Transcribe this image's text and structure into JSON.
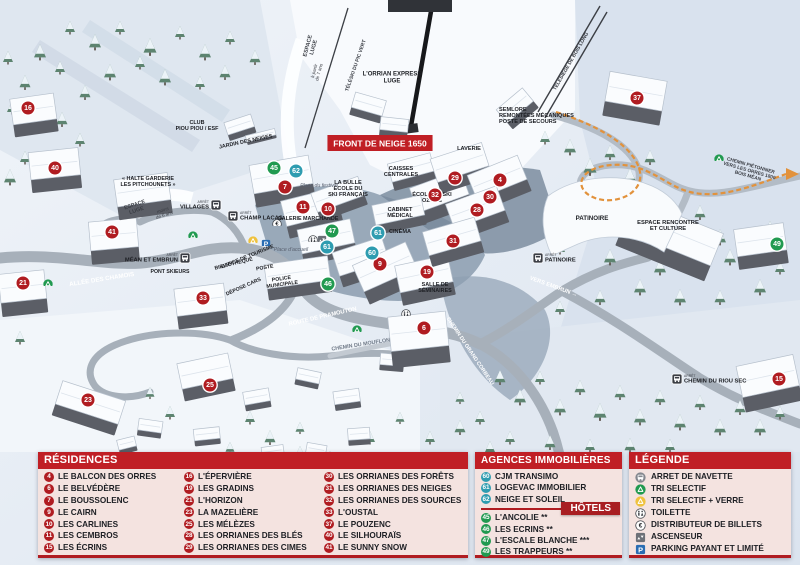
{
  "map": {
    "banner": {
      "text": "FRONT DE NEIGE 1650",
      "x": 380,
      "y": 143
    },
    "marker_colors": {
      "r": "#b01c21",
      "a": "#2e9cb0",
      "h": "#219a50"
    },
    "labels": [
      {
        "t": "ESPACE\nLUGE",
        "x": 312,
        "y": 47,
        "s": 5.5,
        "rot": -75,
        "w": "b",
        "c": "#3a3d44"
      },
      {
        "t": "à partir\nde 7 ans",
        "x": 318,
        "y": 72,
        "s": 4.6,
        "rot": -75,
        "c": "#3a3d44"
      },
      {
        "t": "TÉLÉSKI DU PIC VERT",
        "x": 357,
        "y": 66,
        "s": 5,
        "rot": -71,
        "w": "b",
        "c": "#3a3d44"
      },
      {
        "t": "L'ORRIAN EXPRESS\nLUGE",
        "x": 392,
        "y": 79,
        "s": 6,
        "w": "b",
        "c": "#1d1f24"
      },
      {
        "t": "TÉLÉSIÈGE DE BOIS LONG",
        "x": 572,
        "y": 62,
        "s": 5,
        "rot": -60,
        "w": "b",
        "c": "#3a3d44"
      },
      {
        "t": "SEMLORE\nREMONTÉES MÉCANIQUES\nPOSTE DE SECOURS",
        "x": 499,
        "y": 117,
        "s": 5.6,
        "w": "b",
        "c": "#1d1f24",
        "a": "start"
      },
      {
        "t": "LAVERIE",
        "x": 469,
        "y": 150,
        "s": 5.6,
        "w": "b",
        "c": "#1d1f24"
      },
      {
        "t": "CAISSES\nCENTRALES",
        "x": 401,
        "y": 173,
        "s": 5.6,
        "w": "b",
        "c": "#1d1f24"
      },
      {
        "t": "ÉCOLE DE SKI\nOZONE",
        "x": 432,
        "y": 199,
        "s": 5.6,
        "w": "b",
        "c": "#1d1f24"
      },
      {
        "t": "CABINET\nMÉDICAL",
        "x": 400,
        "y": 214,
        "s": 5.6,
        "w": "b",
        "c": "#1d1f24"
      },
      {
        "t": "CINÉMA",
        "x": 400,
        "y": 233,
        "s": 5.6,
        "w": "b",
        "c": "#1d1f24"
      },
      {
        "t": "LA BULLE\nÉCOLE DU\nSKI FRANÇAIS",
        "x": 348,
        "y": 190,
        "s": 5.6,
        "w": "b",
        "c": "#1d1f24"
      },
      {
        "t": "Place du festival",
        "x": 319,
        "y": 187,
        "s": 5.2,
        "i": true,
        "c": "#5a6170"
      },
      {
        "t": "GALERIE MARCHANDE",
        "x": 308,
        "y": 220,
        "s": 5.4,
        "w": "b",
        "c": "#1d1f24"
      },
      {
        "t": "CLUB\nPIOU PIOU / ESF",
        "x": 197,
        "y": 127,
        "s": 5.4,
        "w": "b",
        "c": "#1d1f24"
      },
      {
        "t": "JARDIN DES NEIGES",
        "x": 246,
        "y": 143,
        "s": 5.4,
        "rot": -12,
        "w": "b",
        "c": "#1d1f24"
      },
      {
        "t": "« HALTE GARDERIE\nLES PITCHOUNETS »",
        "x": 148,
        "y": 183,
        "s": 5.4,
        "w": "b",
        "c": "#1d1f24"
      },
      {
        "t": "ESPACE\nLUGE",
        "x": 136,
        "y": 209,
        "s": 5.4,
        "rot": -18,
        "w": "b",
        "c": "#3a3d44"
      },
      {
        "t": "moins\nde 6 ans",
        "x": 164,
        "y": 214,
        "s": 4.6,
        "rot": -18,
        "c": "#3a3d44"
      },
      {
        "t": "ALLÉE DES CHAMOIS",
        "x": 102,
        "y": 281,
        "s": 6.2,
        "rot": -9,
        "w": "b",
        "c": "#ffffff"
      },
      {
        "t": "PONT SKIEURS",
        "x": 170,
        "y": 273,
        "s": 5.2,
        "w": "b",
        "c": "#1d1f24"
      },
      {
        "t": "BIBLIOTHÈQUE",
        "x": 234,
        "y": 265,
        "s": 5.2,
        "rot": -14,
        "w": "b",
        "c": "#1d1f24"
      },
      {
        "t": "OFFICE DE TOURISME",
        "x": 248,
        "y": 258,
        "s": 5.2,
        "rot": -22,
        "w": "b",
        "c": "#1d1f24"
      },
      {
        "t": "POSTE",
        "x": 265,
        "y": 269,
        "s": 5.2,
        "rot": -10,
        "w": "b",
        "c": "#1d1f24"
      },
      {
        "t": "POLICE\nMUNICIPALE",
        "x": 282,
        "y": 283,
        "s": 5.2,
        "rot": -8,
        "w": "b",
        "c": "#1d1f24"
      },
      {
        "t": "DÉPOSE CARS",
        "x": 244,
        "y": 288,
        "s": 5.2,
        "rot": -24,
        "w": "b",
        "c": "#1d1f24"
      },
      {
        "t": "Place d'accueil",
        "x": 291,
        "y": 251,
        "s": 5.2,
        "i": true,
        "c": "#5a6170"
      },
      {
        "t": "ROUTE DE PRAMOUTON",
        "x": 323,
        "y": 318,
        "s": 5.8,
        "rot": -13,
        "w": "b",
        "c": "#ffffff"
      },
      {
        "t": "CHEMIN DU MOUFLON",
        "x": 361,
        "y": 346,
        "s": 5.4,
        "rot": -9,
        "w": "b",
        "c": "#707a88"
      },
      {
        "t": "CHEMIN DU GRAND CORBEAU",
        "x": 469,
        "y": 352,
        "s": 5.4,
        "rot": 56,
        "w": "b",
        "c": "#ffffff"
      },
      {
        "t": "SALLE DE\nSÉMINAIRES",
        "x": 435,
        "y": 289,
        "s": 5.4,
        "w": "b",
        "c": "#1d1f24"
      },
      {
        "t": "PATINOIRE",
        "x": 592,
        "y": 220,
        "s": 6.2,
        "w": "b",
        "c": "#1d1f24"
      },
      {
        "t": "ESPACE RENCONTRE\nET CULTURE",
        "x": 668,
        "y": 227,
        "s": 5.8,
        "w": "b",
        "c": "#1d1f24"
      },
      {
        "t": "VERS EMBRUN →",
        "x": 553,
        "y": 288,
        "s": 5.8,
        "rot": 20,
        "w": "b",
        "c": "#ffffff"
      },
      {
        "t": "CHEMIN PIÉTONNIER\nVERS LES ORRES 1800\nBOIS MÉAN",
        "x": 749,
        "y": 172,
        "s": 4.8,
        "rot": 16,
        "w": "b",
        "c": "#3a3d44"
      }
    ],
    "markers": [
      {
        "n": "16",
        "x": 28,
        "y": 108,
        "t": "r"
      },
      {
        "n": "40",
        "x": 55,
        "y": 168,
        "t": "r"
      },
      {
        "n": "21",
        "x": 23,
        "y": 283,
        "t": "r"
      },
      {
        "n": "41",
        "x": 112,
        "y": 232,
        "t": "r"
      },
      {
        "n": "33",
        "x": 203,
        "y": 298,
        "t": "r"
      },
      {
        "n": "23",
        "x": 88,
        "y": 400,
        "t": "r"
      },
      {
        "n": "25",
        "x": 210,
        "y": 385,
        "t": "r"
      },
      {
        "n": "7",
        "x": 285,
        "y": 187,
        "t": "r"
      },
      {
        "n": "11",
        "x": 303,
        "y": 207,
        "t": "r"
      },
      {
        "n": "10",
        "x": 328,
        "y": 209,
        "t": "r"
      },
      {
        "n": "9",
        "x": 380,
        "y": 264,
        "t": "r"
      },
      {
        "n": "19",
        "x": 427,
        "y": 272,
        "t": "r"
      },
      {
        "n": "6",
        "x": 424,
        "y": 328,
        "t": "r"
      },
      {
        "n": "29",
        "x": 455,
        "y": 178,
        "t": "r"
      },
      {
        "n": "32",
        "x": 435,
        "y": 195,
        "t": "r"
      },
      {
        "n": "4",
        "x": 500,
        "y": 180,
        "t": "r"
      },
      {
        "n": "30",
        "x": 490,
        "y": 197,
        "t": "r"
      },
      {
        "n": "28",
        "x": 477,
        "y": 210,
        "t": "r"
      },
      {
        "n": "31",
        "x": 453,
        "y": 241,
        "t": "r"
      },
      {
        "n": "37",
        "x": 637,
        "y": 98,
        "t": "r"
      },
      {
        "n": "15",
        "x": 779,
        "y": 379,
        "t": "r"
      },
      {
        "n": "62",
        "x": 296,
        "y": 171,
        "t": "a"
      },
      {
        "n": "61",
        "x": 327,
        "y": 247,
        "t": "a"
      },
      {
        "n": "61",
        "x": 378,
        "y": 233,
        "t": "a"
      },
      {
        "n": "60",
        "x": 372,
        "y": 253,
        "t": "a"
      },
      {
        "n": "45",
        "x": 274,
        "y": 168,
        "t": "h"
      },
      {
        "n": "47",
        "x": 332,
        "y": 231,
        "t": "h"
      },
      {
        "n": "46",
        "x": 328,
        "y": 284,
        "t": "h"
      },
      {
        "n": "49",
        "x": 777,
        "y": 244,
        "t": "h"
      }
    ],
    "bus_stops": [
      {
        "name": "VILLAGES",
        "stop_word": "ARRÊT",
        "x": 216,
        "y": 205,
        "side": "left"
      },
      {
        "name": "CHAMP LACAS",
        "stop_word": "ARRÊT",
        "x": 233,
        "y": 216,
        "side": "right"
      },
      {
        "name": "MÉAN ET EMBRUN",
        "stop_word": "ARRÊT",
        "x": 185,
        "y": 258,
        "side": "left"
      },
      {
        "name": "PATINOIRE",
        "stop_word": "ARRÊT",
        "x": 538,
        "y": 258,
        "side": "right"
      },
      {
        "name": "CHEMIN DU RIOU SEC",
        "stop_word": "ARRÊT",
        "x": 677,
        "y": 379,
        "side": "right"
      }
    ],
    "poi_icons": [
      {
        "icon": "recycle-green-icon",
        "x": 48,
        "y": 281
      },
      {
        "icon": "recycle-green-icon",
        "x": 193,
        "y": 233
      },
      {
        "icon": "recycle-green-icon",
        "x": 357,
        "y": 327
      },
      {
        "icon": "recycle-green-icon",
        "x": 719,
        "y": 156
      },
      {
        "icon": "recycle-yellow-icon",
        "x": 253,
        "y": 238
      },
      {
        "icon": "parking-icon",
        "x": 266,
        "y": 241
      },
      {
        "icon": "euro-icon",
        "x": 277,
        "y": 221
      },
      {
        "icon": "toilet-icon",
        "x": 313,
        "y": 237
      },
      {
        "icon": "elevator-icon",
        "x": 322,
        "y": 237
      },
      {
        "icon": "toilet-icon",
        "x": 406,
        "y": 311
      }
    ]
  },
  "panel": {
    "residences": {
      "title": "RÉSIDENCES",
      "columns": [
        [
          {
            "num": "4",
            "label": "LE BALCON DES ORRES"
          },
          {
            "num": "6",
            "label": "LE BELVÉDÈRE"
          },
          {
            "num": "7",
            "label": "LE BOUSSOLENC"
          },
          {
            "num": "9",
            "label": "LE CAIRN"
          },
          {
            "num": "10",
            "label": "LES CARLINES"
          },
          {
            "num": "11",
            "label": "LES CEMBROS"
          },
          {
            "num": "15",
            "label": "LES ÉCRINS"
          }
        ],
        [
          {
            "num": "16",
            "label": "L'ÉPERVIÈRE"
          },
          {
            "num": "19",
            "label": "LES GRADINS"
          },
          {
            "num": "21",
            "label": "L'HORIZON"
          },
          {
            "num": "23",
            "label": "LA MAZELIÈRE"
          },
          {
            "num": "25",
            "label": "LES MÉLÈZES"
          },
          {
            "num": "28",
            "label": "LES ORRIANES DES BLÉS"
          },
          {
            "num": "29",
            "label": "LES ORRIANES DES CIMES"
          }
        ],
        [
          {
            "num": "30",
            "label": "LES ORRIANES DES FORÊTS"
          },
          {
            "num": "31",
            "label": "LES ORRIANES DES NEIGES"
          },
          {
            "num": "32",
            "label": "LES ORRIANES DES SOURCES"
          },
          {
            "num": "33",
            "label": "L'OUSTAL"
          },
          {
            "num": "37",
            "label": "LE POUZENC"
          },
          {
            "num": "40",
            "label": "LE SILHOURAÏS"
          },
          {
            "num": "41",
            "label": "LE SUNNY SNOW"
          }
        ]
      ]
    },
    "agencies": {
      "title": "AGENCES IMMOBILIÈRES",
      "items": [
        {
          "num": "60",
          "label": "CJM TRANSIMO"
        },
        {
          "num": "61",
          "label": "LOGEVAC IMMOBILIER"
        },
        {
          "num": "62",
          "label": "NEIGE ET SOLEIL"
        }
      ]
    },
    "hotels": {
      "title": "HÔTELS",
      "items": [
        {
          "num": "45",
          "label": "L'ANCOLIE **"
        },
        {
          "num": "46",
          "label": "LES ECRINS **"
        },
        {
          "num": "47",
          "label": "L'ESCALE BLANCHE ***"
        },
        {
          "num": "49",
          "label": "LES TRAPPEURS **"
        }
      ]
    },
    "legend": {
      "title": "LÉGENDE",
      "items": [
        {
          "icon": "bus-icon",
          "label": "ARRET DE NAVETTE"
        },
        {
          "icon": "recycle-green-icon",
          "label": "TRI SELECTIF"
        },
        {
          "icon": "recycle-yellow-icon",
          "label": "TRI SELECTIF + VERRE"
        },
        {
          "icon": "toilet-icon",
          "label": "TOILETTE"
        },
        {
          "icon": "euro-icon",
          "label": "DISTRIBUTEUR DE BILLETS"
        },
        {
          "icon": "elevator-icon",
          "label": "ASCENSEUR"
        },
        {
          "icon": "parking-icon",
          "label": "PARKING PAYANT ET LIMITÉ"
        }
      ]
    }
  }
}
